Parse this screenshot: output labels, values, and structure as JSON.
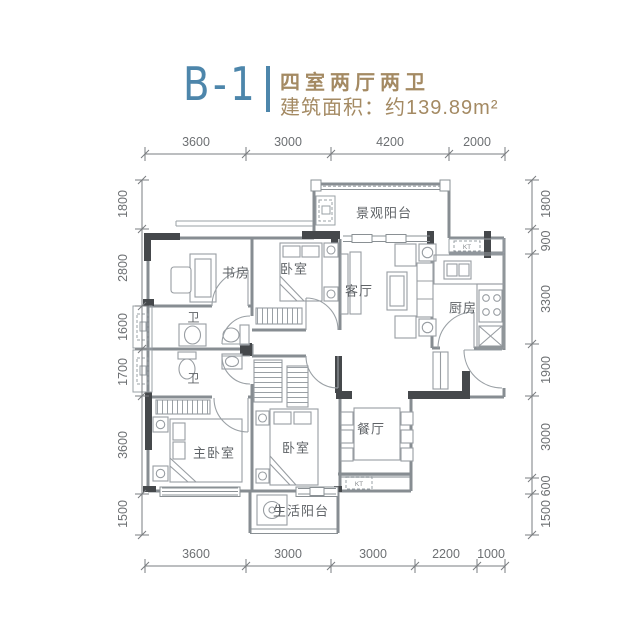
{
  "header": {
    "unit_code": "B-1",
    "layout_type": "四室两厅两卫",
    "area_label": "建筑面积：约139.89m²"
  },
  "rooms": [
    {
      "name": "view-balcony",
      "label": "景观阳台"
    },
    {
      "name": "study",
      "label": "书房"
    },
    {
      "name": "bedroom-upper",
      "label": "卧室"
    },
    {
      "name": "living-room",
      "label": "客厅"
    },
    {
      "name": "kitchen",
      "label": "厨房"
    },
    {
      "name": "bathroom-upper",
      "label": "卫"
    },
    {
      "name": "bathroom-lower",
      "label": "卫"
    },
    {
      "name": "master-bedroom",
      "label": "主卧室"
    },
    {
      "name": "bedroom-lower",
      "label": "卧室"
    },
    {
      "name": "dining-room",
      "label": "餐厅"
    },
    {
      "name": "laundry-balcony",
      "label": "生活阳台"
    }
  ],
  "dimensions": {
    "top": [
      "3600",
      "3000",
      "4200",
      "2000"
    ],
    "bottom": [
      "3600",
      "3000",
      "3000",
      "2200",
      "1000"
    ],
    "left": [
      "1800",
      "2800",
      "1600",
      "1700",
      "3600",
      "1500"
    ],
    "right": [
      "1800",
      "900",
      "3300",
      "1900",
      "3000",
      "600",
      "1500"
    ]
  },
  "annotations": {
    "ac_unit": "KT"
  },
  "colors": {
    "accent_blue": "#4d86ab",
    "accent_brown": "#a48a63",
    "wall_gray": "#878d92",
    "wall_dark": "#45484b",
    "label_gray": "#5f6367",
    "dim_gray": "#6d7073"
  }
}
